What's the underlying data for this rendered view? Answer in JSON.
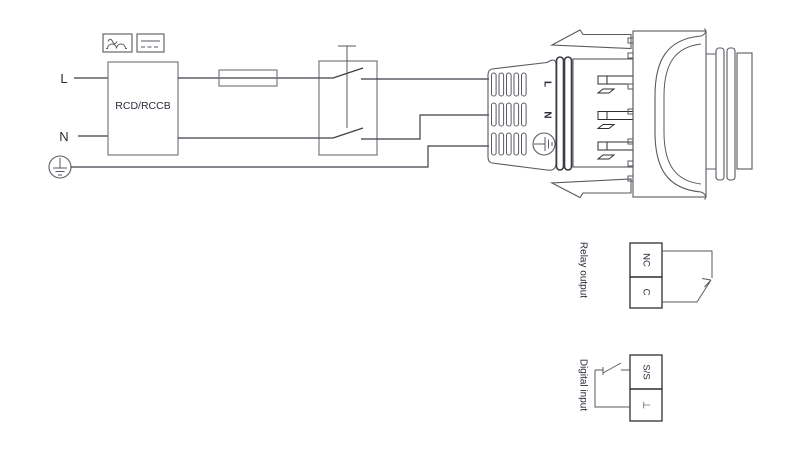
{
  "supply": {
    "live": "L",
    "neutral": "N",
    "earth_icon": "protective-earth-icon"
  },
  "rcd": {
    "label": "RCD/RCCB",
    "symbols": [
      "pulsating-current-icon",
      "smooth-dc-icon"
    ]
  },
  "plug": {
    "terminals": {
      "live": "L",
      "neutral": "N",
      "earth_icon": "protective-earth-icon"
    }
  },
  "relay_output": {
    "title": "Relay output",
    "terminals": [
      "NC",
      "C"
    ]
  },
  "digital_input": {
    "title": "Digital input",
    "terminals": [
      "S/S",
      "⊥"
    ]
  },
  "colors": {
    "background": "#ffffff",
    "wire": "#3f3f47",
    "component_outline": "#7a7a82",
    "mechanical_drawing": "#5a5a62",
    "terminal_dark": "#2e2e36",
    "text": "#2b2b3a"
  }
}
